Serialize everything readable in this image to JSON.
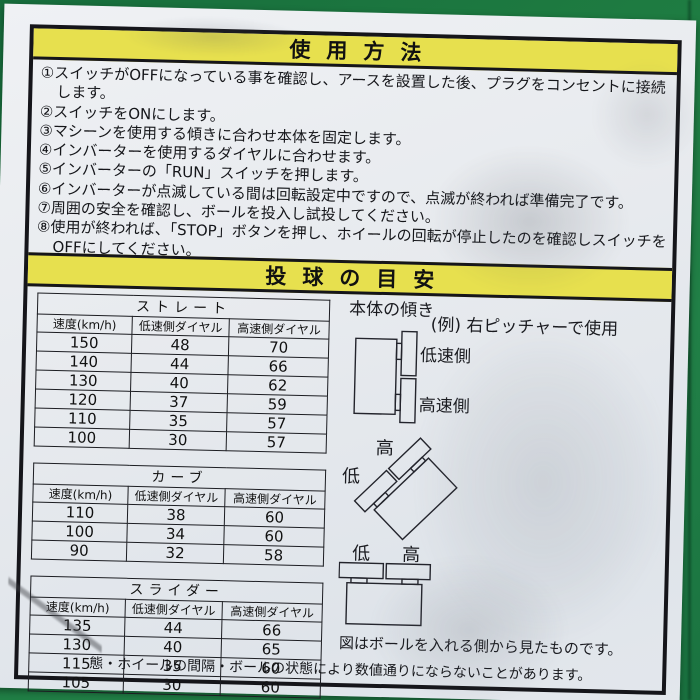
{
  "photo": {
    "background_color": "#1e7b41",
    "sticker_color": "#e8ebee",
    "band_color": "#e7e04e"
  },
  "usage": {
    "title": "使用方法",
    "instructions": [
      "①スイッチがOFFになっている事を確認し、アースを設置した後、プラグをコンセントに接続します。",
      "②スイッチをONにします。",
      "③マシーンを使用する傾きに合わせ本体を固定します。",
      "④インバーターを使用するダイヤルに合わせます。",
      "⑤インバーターの「RUN」スイッチを押します。",
      "⑥インバーターが点滅している間は回転設定中ですので、点滅が終われば準備完了です。",
      "⑦周囲の安全を確認し、ボールを投入し試投してください。",
      "⑧使用が終われば、「STOP」ボタンを押し、ホイールの回転が停止したのを確認しスイッチをOFFにしてください。"
    ]
  },
  "guide": {
    "title": "投球の目安",
    "tables": [
      {
        "title": "ストレート",
        "headers": [
          "速度(km/h)",
          "低速側ダイヤル",
          "高速側ダイヤル"
        ],
        "rows": [
          [
            "150",
            "48",
            "70"
          ],
          [
            "140",
            "44",
            "66"
          ],
          [
            "130",
            "40",
            "62"
          ],
          [
            "120",
            "37",
            "59"
          ],
          [
            "110",
            "35",
            "57"
          ],
          [
            "100",
            "30",
            "57"
          ]
        ]
      },
      {
        "title": "カーブ",
        "headers": [
          "速度(km/h)",
          "低速側ダイヤル",
          "高速側ダイヤル"
        ],
        "rows": [
          [
            "110",
            "38",
            "60"
          ],
          [
            "100",
            "34",
            "60"
          ],
          [
            "90",
            "32",
            "58"
          ]
        ]
      },
      {
        "title": "スライダー",
        "headers": [
          "速度(km/h)",
          "低速側ダイヤル",
          "高速側ダイヤル"
        ],
        "rows": [
          [
            "135",
            "44",
            "66"
          ],
          [
            "130",
            "40",
            "65"
          ],
          [
            "115",
            "35",
            "60"
          ],
          [
            "105",
            "30",
            "60"
          ]
        ]
      }
    ],
    "diagram": {
      "heading": "本体の傾き",
      "example": "(例) 右ピッチャーで使用",
      "low_speed_side": "低速側",
      "high_speed_side": "高速側",
      "high": "高",
      "low": "低",
      "caption": "図はボールを入れる側から見たものです。"
    },
    "footnote": "態・ホイールの間隔・ボールの状態により数値通りにならないことがあります。"
  }
}
